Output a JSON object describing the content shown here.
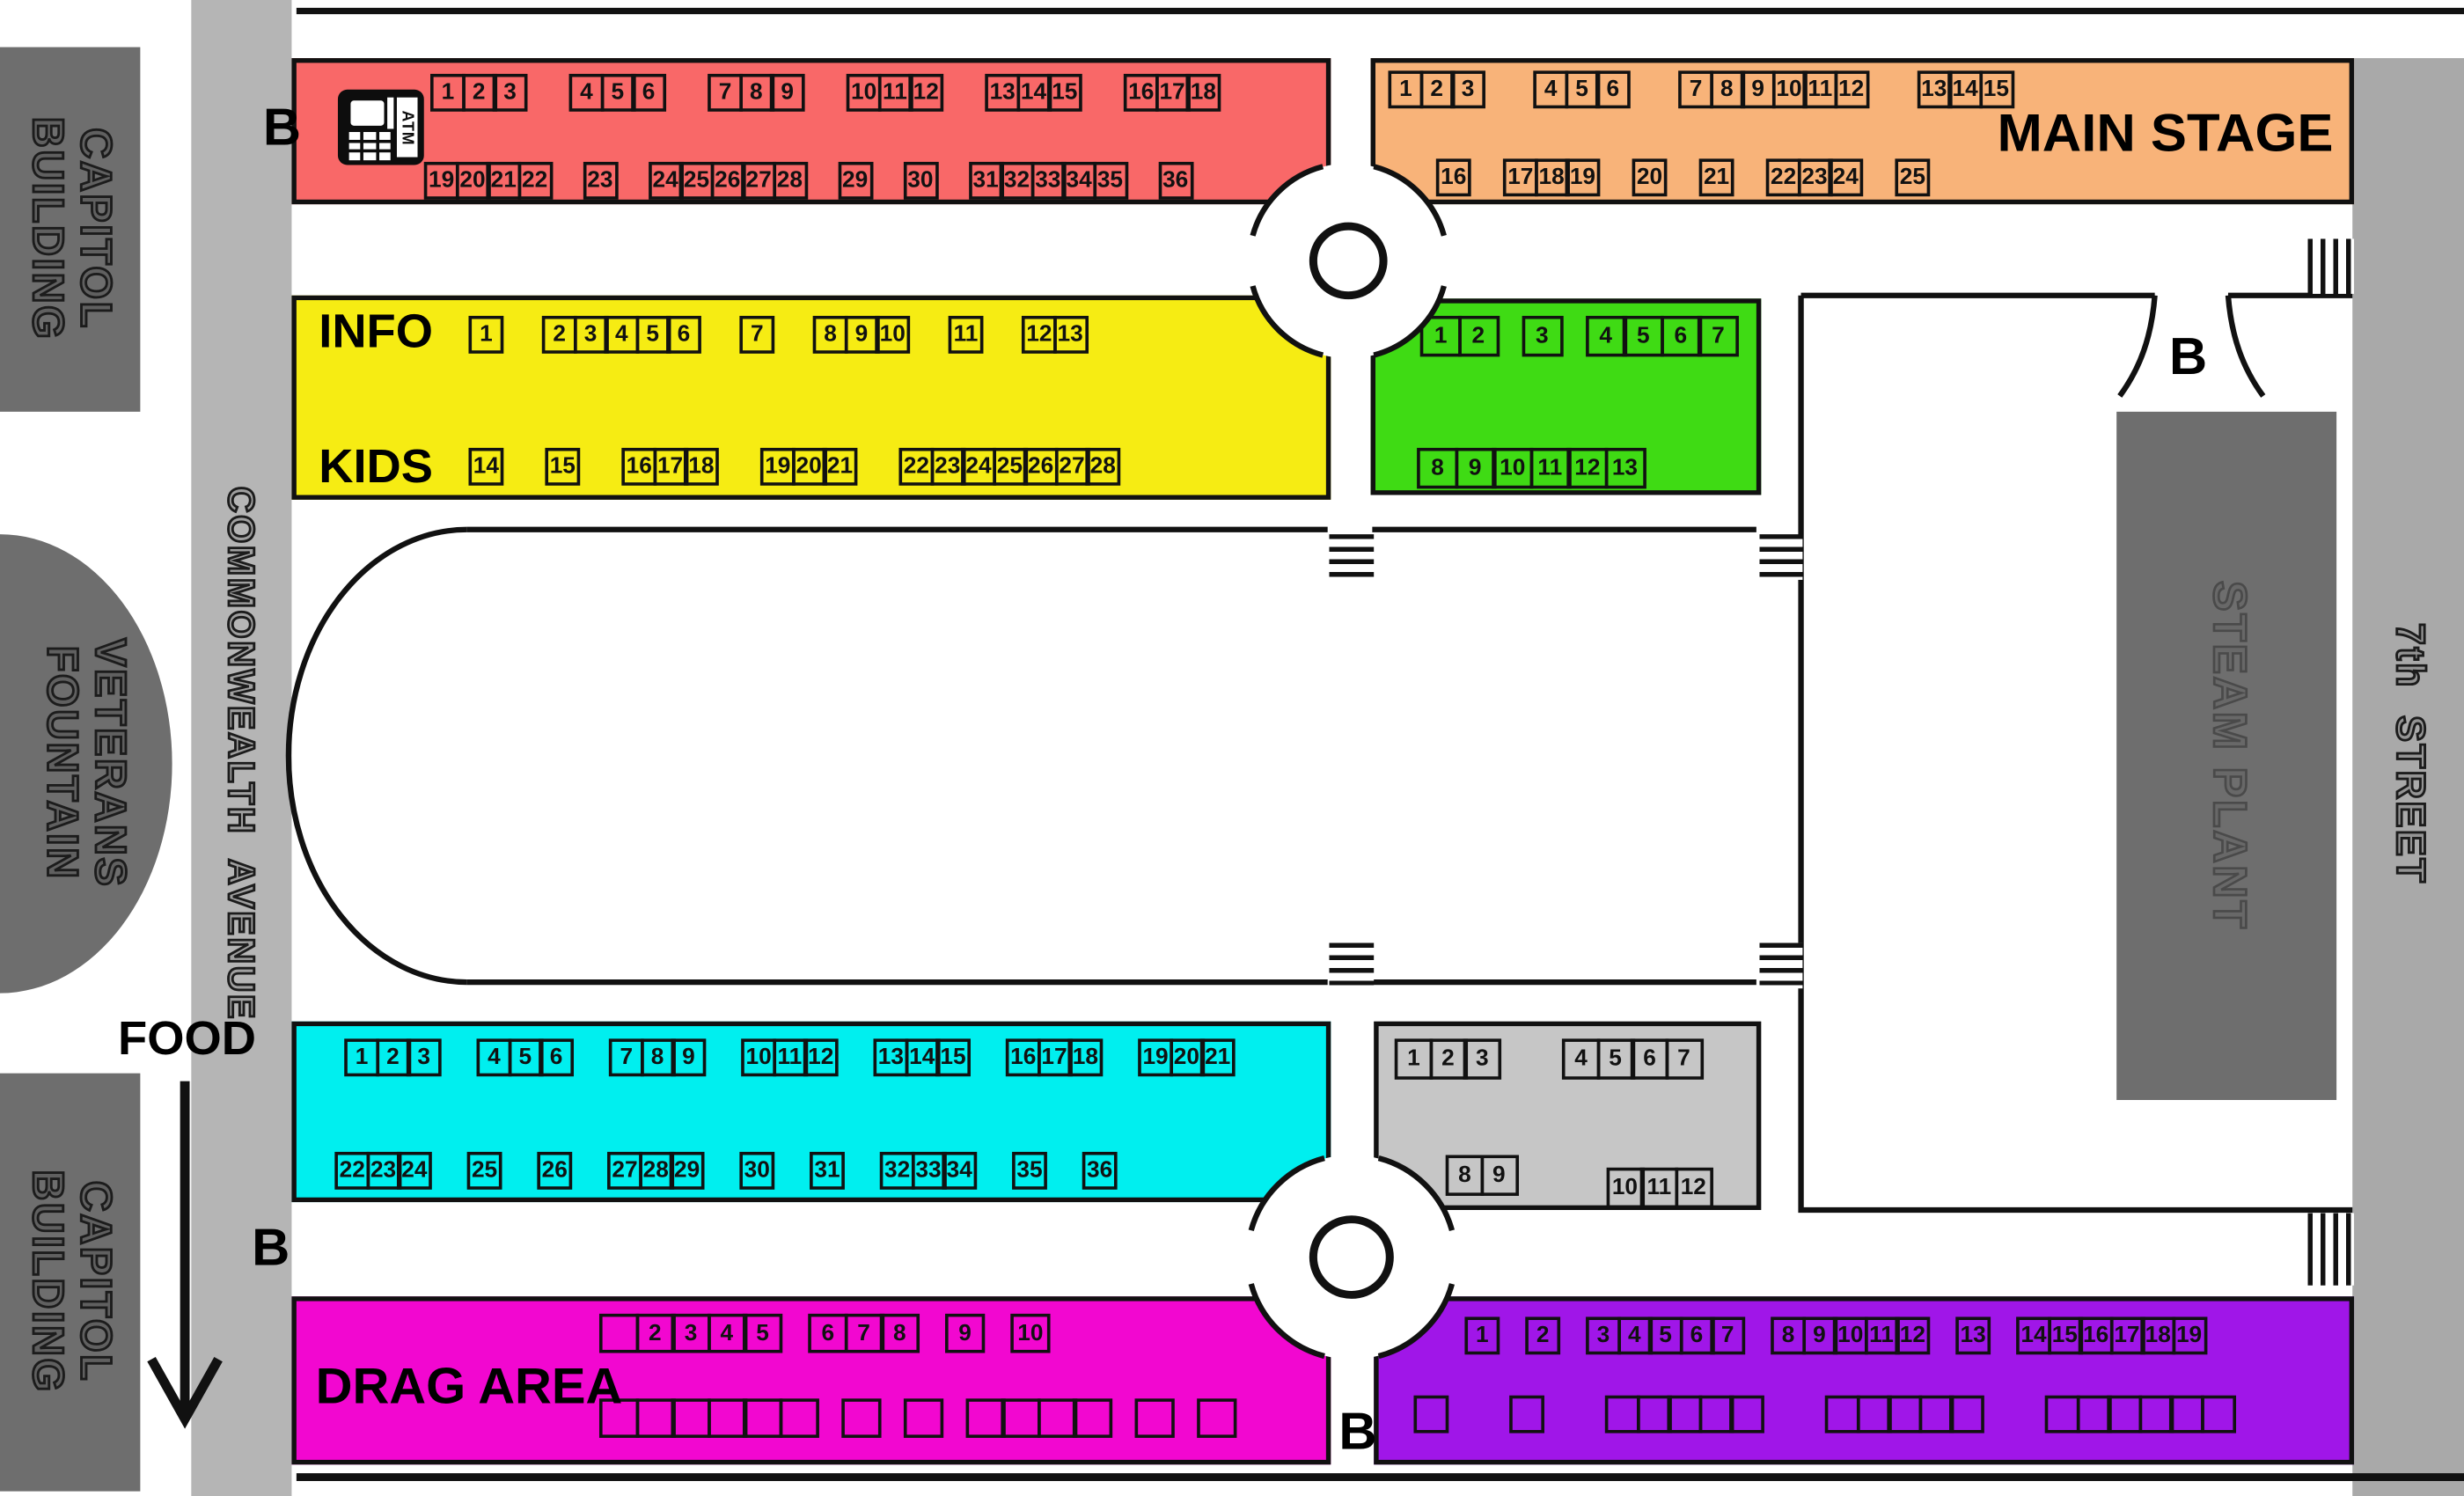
{
  "labels": {
    "info": "INFO",
    "kids": "KIDS",
    "food": "FOOD",
    "drag_area": "DRAG AREA",
    "main_stage": "MAIN STAGE",
    "bus": "B",
    "atm": "ATM"
  },
  "buildings": {
    "capitol_top": "CAPITOL\nBUILDING",
    "veterans": "VETERANS\nFOUNTAIN",
    "capitol_bottom": "CAPITOL\nBUILDING",
    "steam_plant": "STEAM PLANT"
  },
  "streets": {
    "commonwealth": "COMMONWEALTH  AVENUE",
    "seventh": "7th  STREET"
  },
  "colors": {
    "red": "#F96868",
    "orange": "#F8B379",
    "yellow": "#F6EC13",
    "green": "#3FDB14",
    "cyan": "#00EFEF",
    "gray": "#C6C6C6",
    "magenta": "#F207D0",
    "purple": "#A016E8",
    "building": "#6E6E6E",
    "avenue": "#B5B5B5",
    "street": "#A9A9A9"
  },
  "zones": {
    "red": {
      "rows": [
        [
          [
            "1",
            "2",
            "3"
          ],
          [
            "4",
            "5",
            "6"
          ],
          [
            "7",
            "8",
            "9"
          ],
          [
            "10",
            "11",
            "12"
          ],
          [
            "13",
            "14",
            "15"
          ],
          [
            "16",
            "17",
            "18"
          ]
        ],
        [
          [
            "19",
            "20",
            "21",
            "22"
          ],
          [
            "23"
          ],
          [
            "24",
            "25",
            "26",
            "27",
            "28"
          ],
          [
            "29"
          ],
          [
            "30"
          ],
          [
            "31",
            "32",
            "33",
            "34",
            "35"
          ],
          [
            "36"
          ]
        ]
      ]
    },
    "orange": {
      "rows": [
        [
          [
            "1",
            "2",
            "3"
          ],
          [
            "4",
            "5",
            "6"
          ],
          [
            "7",
            "8",
            "9",
            "10",
            "11",
            "12"
          ],
          [
            "13",
            "14",
            "15"
          ]
        ],
        [
          [
            "16"
          ],
          [
            "17",
            "18",
            "19"
          ],
          [
            "20"
          ],
          [
            "21"
          ],
          [
            "22",
            "23",
            "24"
          ],
          [
            "25"
          ]
        ]
      ]
    },
    "yellow": {
      "rows": [
        [
          [
            "1"
          ],
          [
            "2",
            "3",
            "4",
            "5",
            "6"
          ],
          [
            "7"
          ],
          [
            "8",
            "9",
            "10"
          ],
          [
            "11"
          ],
          [
            "12",
            "13"
          ]
        ],
        [
          [
            "14"
          ],
          [
            "15"
          ],
          [
            "16",
            "17",
            "18"
          ],
          [
            "19",
            "20",
            "21"
          ],
          [
            "22",
            "23",
            "24",
            "25",
            "26",
            "27",
            "28"
          ]
        ]
      ]
    },
    "green": {
      "rows": [
        [
          [
            "1",
            "2"
          ],
          [
            "3"
          ],
          [
            "4",
            "5",
            "6",
            "7"
          ]
        ],
        [
          [
            "8",
            "9",
            "10",
            "11",
            "12",
            "13"
          ]
        ]
      ]
    },
    "cyan": {
      "rows": [
        [
          [
            "1",
            "2",
            "3"
          ],
          [
            "4",
            "5",
            "6"
          ],
          [
            "7",
            "8",
            "9"
          ],
          [
            "10",
            "11",
            "12"
          ],
          [
            "13",
            "14",
            "15"
          ],
          [
            "16",
            "17",
            "18"
          ],
          [
            "19",
            "20",
            "21"
          ]
        ],
        [
          [
            "22",
            "23",
            "24"
          ],
          [
            "25"
          ],
          [
            "26"
          ],
          [
            "27",
            "28",
            "29"
          ],
          [
            "30"
          ],
          [
            "31"
          ],
          [
            "32",
            "33",
            "34"
          ],
          [
            "35"
          ],
          [
            "36"
          ]
        ]
      ]
    },
    "gray": {
      "rows": [
        [
          [
            "1",
            "2",
            "3"
          ],
          [
            "4",
            "5",
            "6",
            "7"
          ]
        ],
        [
          [
            "8",
            "9"
          ],
          [
            "10",
            "11",
            "12"
          ]
        ]
      ]
    },
    "magenta": {
      "rows": [
        [
          [
            "",
            "2",
            "3",
            "4",
            "5"
          ],
          [
            "6",
            "7",
            "8"
          ],
          [
            "9"
          ],
          [
            "10"
          ]
        ],
        [
          [
            "",
            "",
            "",
            "",
            "",
            ""
          ],
          [
            ""
          ],
          [
            ""
          ],
          [
            "",
            "",
            "",
            ""
          ],
          [
            ""
          ],
          [
            ""
          ]
        ]
      ]
    },
    "purple": {
      "rows": [
        [
          [
            "1"
          ],
          [
            "2"
          ],
          [
            "3",
            "4",
            "5",
            "6",
            "7"
          ],
          [
            "8",
            "9",
            "10",
            "11",
            "12"
          ],
          [
            "13"
          ],
          [
            "14",
            "15",
            "16",
            "17",
            "18",
            "19"
          ]
        ],
        [
          [
            ""
          ],
          [
            ""
          ],
          [
            "",
            "",
            "",
            "",
            ""
          ],
          [
            "",
            "",
            "",
            "",
            ""
          ],
          [
            "",
            "",
            "",
            "",
            "",
            ""
          ]
        ]
      ]
    }
  }
}
